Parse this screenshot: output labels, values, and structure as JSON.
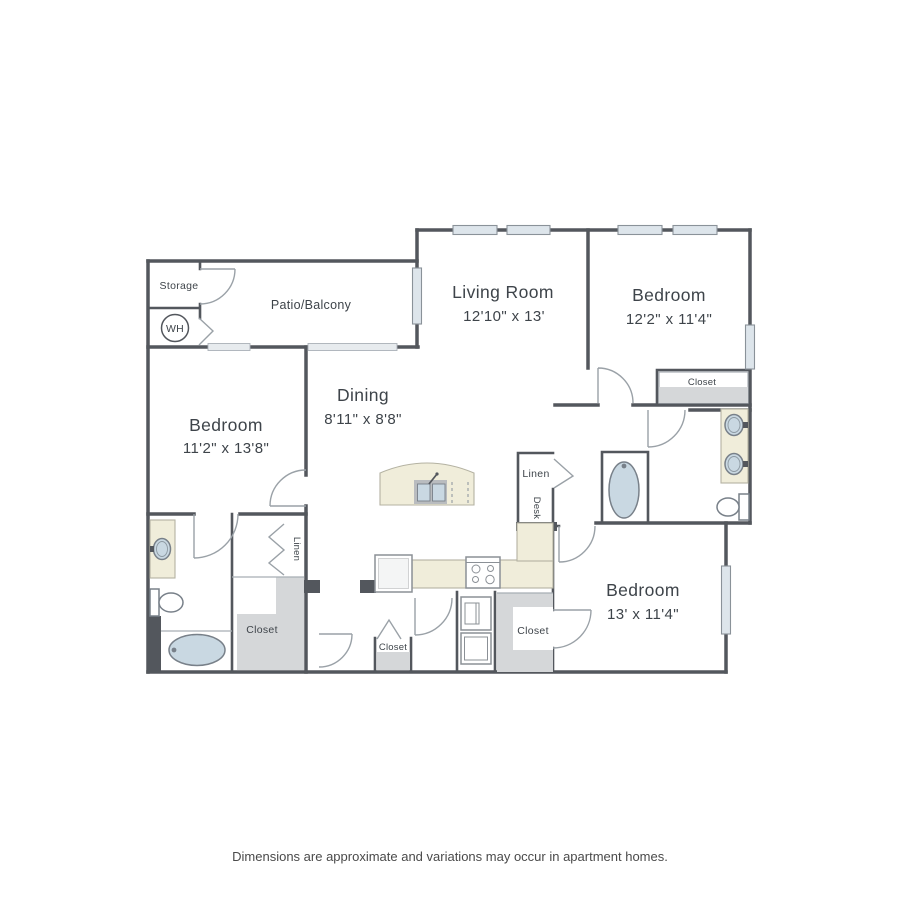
{
  "plan": {
    "labels": {
      "storage": "Storage",
      "water_heater": "WH",
      "patio": "Patio/Balcony",
      "living": {
        "name": "Living Room",
        "dims": "12'10\" x 13'"
      },
      "bedroom_top_right": {
        "name": "Bedroom",
        "dims": "12'2\" x 11'4\""
      },
      "bedroom_left": {
        "name": "Bedroom",
        "dims": "11'2\" x 13'8\""
      },
      "bedroom_bottom_right": {
        "name": "Bedroom",
        "dims": "13' x 11'4\""
      },
      "dining": {
        "name": "Dining",
        "dims": "8'11\" x 8'8\""
      },
      "closet_bedroom_tr": "Closet",
      "closet_bedroom_left": "Closet",
      "closet_hall": "Closet",
      "closet_bedroom_br": "Closet",
      "linen_bedroom_left": "Linen",
      "linen_hall": "Linen",
      "desk": "Desk"
    },
    "colors": {
      "wall": "#53575d",
      "window_fill": "#dde5eb",
      "counter_fill": "#f0edda",
      "closet_floor": "#d5d7d9",
      "fixture_fill": "#c9d8e2",
      "label_text": "#3e444a"
    }
  },
  "footer": {
    "disclaimer": "Dimensions are approximate and variations may occur in apartment homes."
  }
}
